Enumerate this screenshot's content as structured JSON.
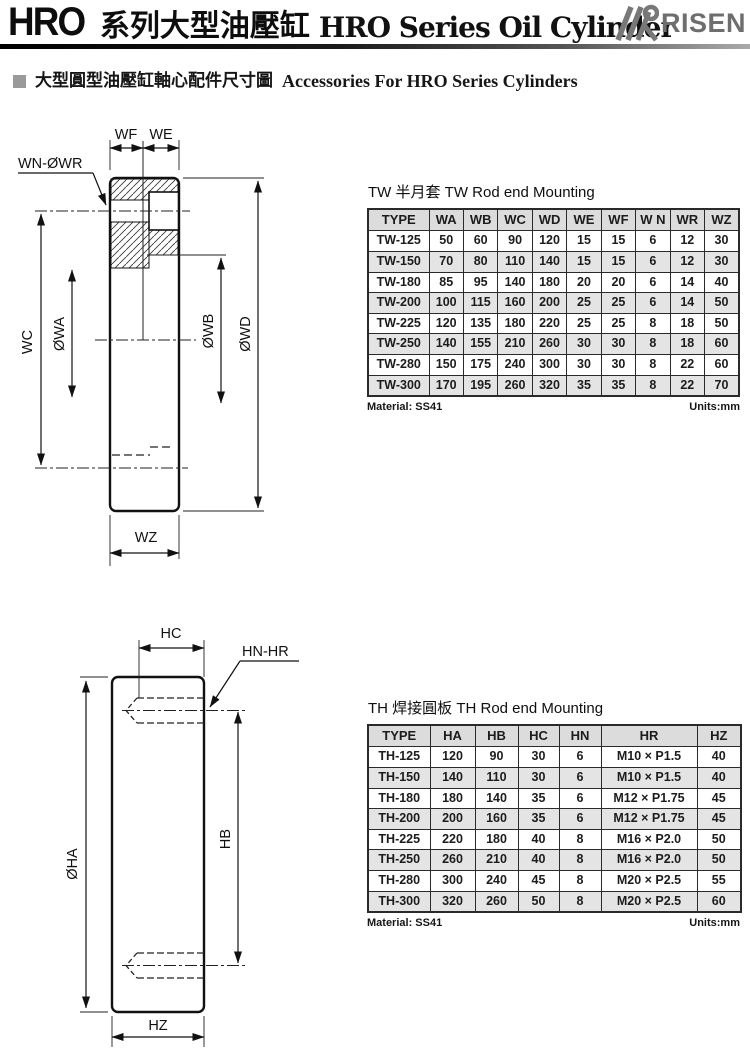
{
  "header": {
    "title_code": "HRO",
    "title_cjk": "系列大型油壓缸",
    "title_en": "HRO Series Oil Cylinder",
    "brand": "RISEN",
    "brand_color": "#6e6e6e"
  },
  "subtitle": {
    "cjk": "大型圓型油壓缸軸心配件尺寸圖",
    "en": "Accessories For HRO Series Cylinders"
  },
  "tw": {
    "title": "TW 半月套 TW Rod end Mounting",
    "table": {
      "headers": [
        "TYPE",
        "WA",
        "WB",
        "WC",
        "WD",
        "WE",
        "WF",
        "W N",
        "WR",
        "WZ"
      ],
      "rows": [
        [
          "TW-125",
          "50",
          "60",
          "90",
          "120",
          "15",
          "15",
          "6",
          "12",
          "30"
        ],
        [
          "TW-150",
          "70",
          "80",
          "110",
          "140",
          "15",
          "15",
          "6",
          "12",
          "30"
        ],
        [
          "TW-180",
          "85",
          "95",
          "140",
          "180",
          "20",
          "20",
          "6",
          "14",
          "40"
        ],
        [
          "TW-200",
          "100",
          "115",
          "160",
          "200",
          "25",
          "25",
          "6",
          "14",
          "50"
        ],
        [
          "TW-225",
          "120",
          "135",
          "180",
          "220",
          "25",
          "25",
          "8",
          "18",
          "50"
        ],
        [
          "TW-250",
          "140",
          "155",
          "210",
          "260",
          "30",
          "30",
          "8",
          "18",
          "60"
        ],
        [
          "TW-280",
          "150",
          "175",
          "240",
          "300",
          "30",
          "30",
          "8",
          "22",
          "60"
        ],
        [
          "TW-300",
          "170",
          "195",
          "260",
          "320",
          "35",
          "35",
          "8",
          "22",
          "70"
        ]
      ]
    },
    "material": "Material: SS41",
    "units": "Units:mm",
    "labels": {
      "wf": "WF",
      "we": "WE",
      "wn_wr": "WN-ØWR",
      "wc": "WC",
      "wa": "ØWA",
      "wb": "ØWB",
      "wd": "ØWD",
      "wz": "WZ"
    }
  },
  "th": {
    "title": "TH 焊接圓板 TH Rod end Mounting",
    "table": {
      "headers": [
        "TYPE",
        "HA",
        "HB",
        "HC",
        "HN",
        "HR",
        "HZ"
      ],
      "rows": [
        [
          "TH-125",
          "120",
          "90",
          "30",
          "6",
          "M10 × P1.5",
          "40"
        ],
        [
          "TH-150",
          "140",
          "110",
          "30",
          "6",
          "M10 × P1.5",
          "40"
        ],
        [
          "TH-180",
          "180",
          "140",
          "35",
          "6",
          "M12 × P1.75",
          "45"
        ],
        [
          "TH-200",
          "200",
          "160",
          "35",
          "6",
          "M12 × P1.75",
          "45"
        ],
        [
          "TH-225",
          "220",
          "180",
          "40",
          "8",
          "M16 × P2.0",
          "50"
        ],
        [
          "TH-250",
          "260",
          "210",
          "40",
          "8",
          "M16 × P2.0",
          "50"
        ],
        [
          "TH-280",
          "300",
          "240",
          "45",
          "8",
          "M20 × P2.5",
          "55"
        ],
        [
          "TH-300",
          "320",
          "260",
          "50",
          "8",
          "M20 × P2.5",
          "60"
        ]
      ]
    },
    "material": "Material: SS41",
    "units": "Units:mm",
    "labels": {
      "hc": "HC",
      "hn_hr": "HN-HR",
      "ha": "ØHA",
      "hb": "HB",
      "hz": "HZ"
    }
  }
}
